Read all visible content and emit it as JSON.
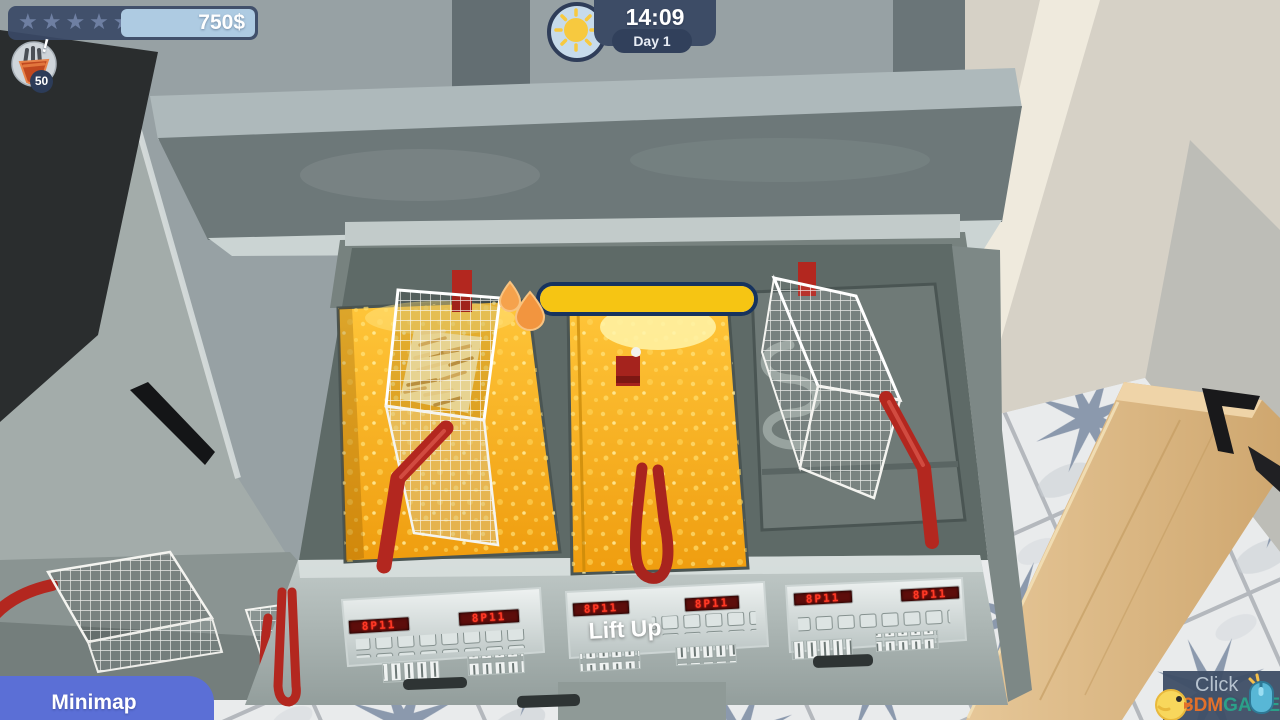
{
  "hud": {
    "rating": {
      "star_glyph": "★★★★★",
      "stars_total": 5,
      "stars_filled": 0
    },
    "money": "750$",
    "alert": {
      "badge_count": "50",
      "alert_glyph": "!"
    },
    "clock": {
      "time": "14:09",
      "day": "Day 1"
    }
  },
  "fryer": {
    "interaction_label": "Lift Up",
    "progress_percent": 100,
    "panel_led_text": "8P11",
    "vats": [
      {
        "position": "left",
        "contents": "oil",
        "basket": "basket with raw fries"
      },
      {
        "position": "middle",
        "contents": "oil",
        "basket": "submerged handle"
      },
      {
        "position": "right",
        "contents": "empty",
        "basket": "empty basket"
      }
    ]
  },
  "minimap": {
    "label": "Minimap"
  },
  "watermark": {
    "line1": "Click",
    "brand": "3DM",
    "brand2": "GAME"
  },
  "colors": {
    "accent_blue": "#5b6fd6",
    "hud_navy": "#3b4a63",
    "money_box": "#aecbe2",
    "oil_gold": "#f2a714",
    "progress_yellow": "#f6c513",
    "progress_border": "#17335e",
    "handle_red": "#b3271f",
    "led_red": "#ff3222",
    "wood": "#d9b27c",
    "tile_star": "#8291a8",
    "brand_orange": "#e2702a",
    "brand_teal": "#2ba089"
  }
}
